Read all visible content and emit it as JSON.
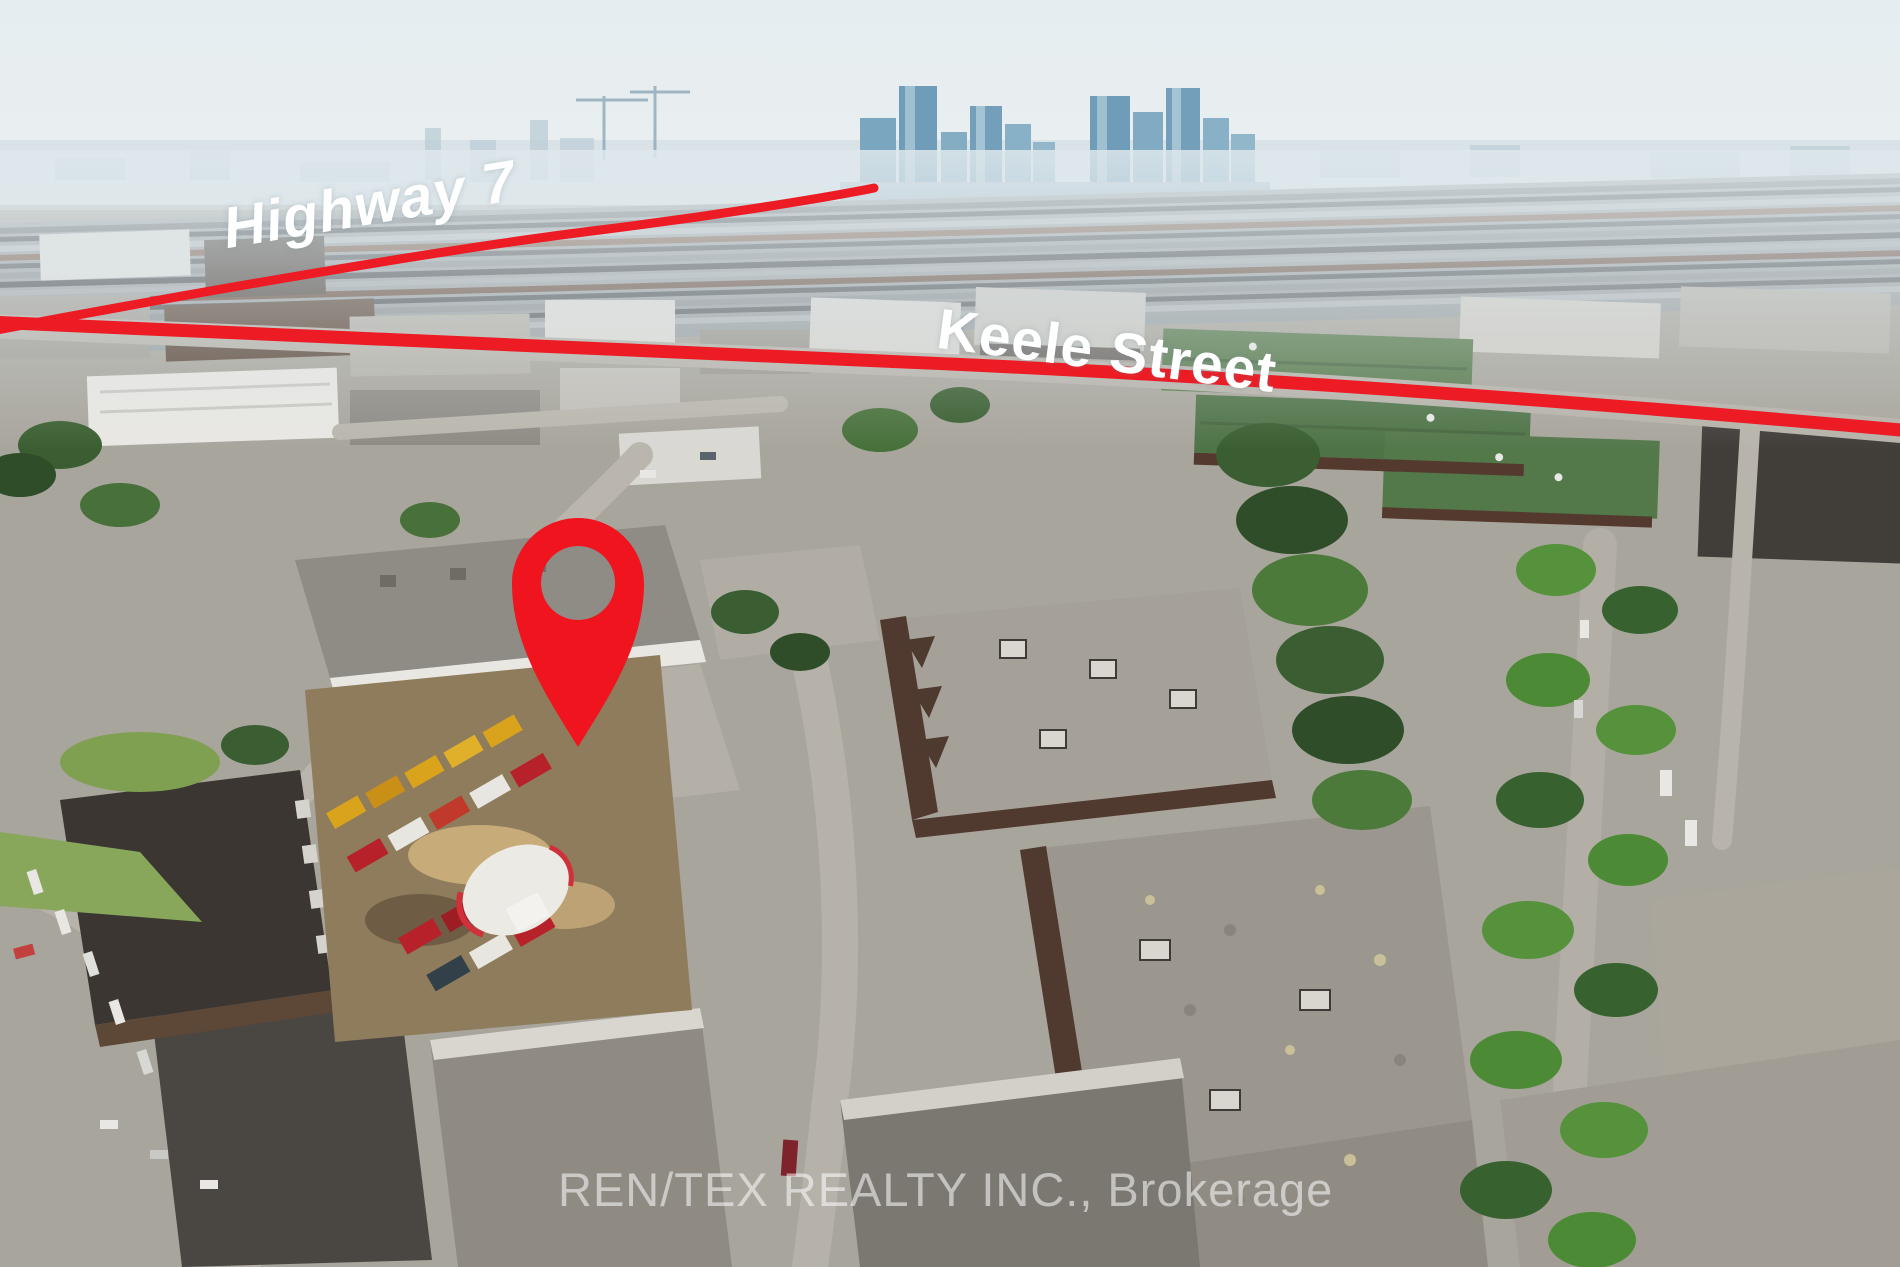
{
  "annotations": {
    "highway_label": "Highway 7",
    "street_label": "Keele Street",
    "route_color": "#ED1B24",
    "pin_color": "#F0141F",
    "label_color": "#FFFFFF"
  },
  "watermark": {
    "text": "REN/TEX REALTY INC., Brokerage",
    "color": "#FFFFFF"
  }
}
